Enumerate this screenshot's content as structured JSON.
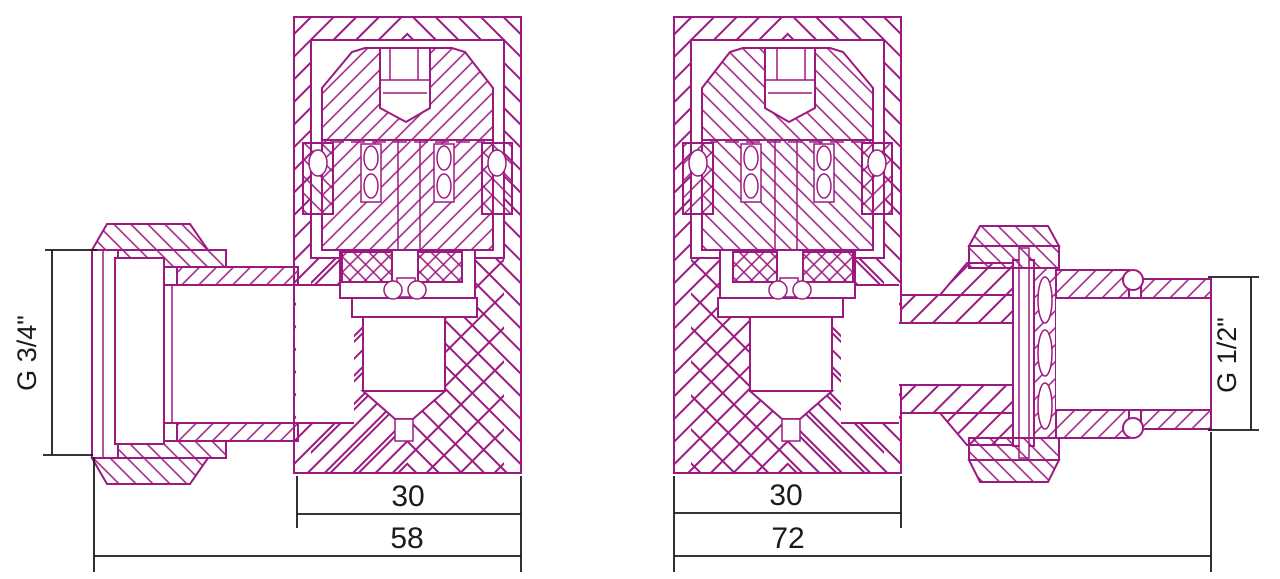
{
  "colors": {
    "line": "#9C1A80",
    "dimension": "#1A1A1A",
    "background": "#FFFFFF"
  },
  "left_valve": {
    "name": "angle valve cross-section, union nut left",
    "thread_label": "G 3/4\"",
    "dim_body_width": "30",
    "dim_total_width": "58"
  },
  "right_valve": {
    "name": "angle valve cross-section, male thread right",
    "thread_label": "G 1/2\"",
    "dim_body_width": "30",
    "dim_total_width": "72"
  }
}
